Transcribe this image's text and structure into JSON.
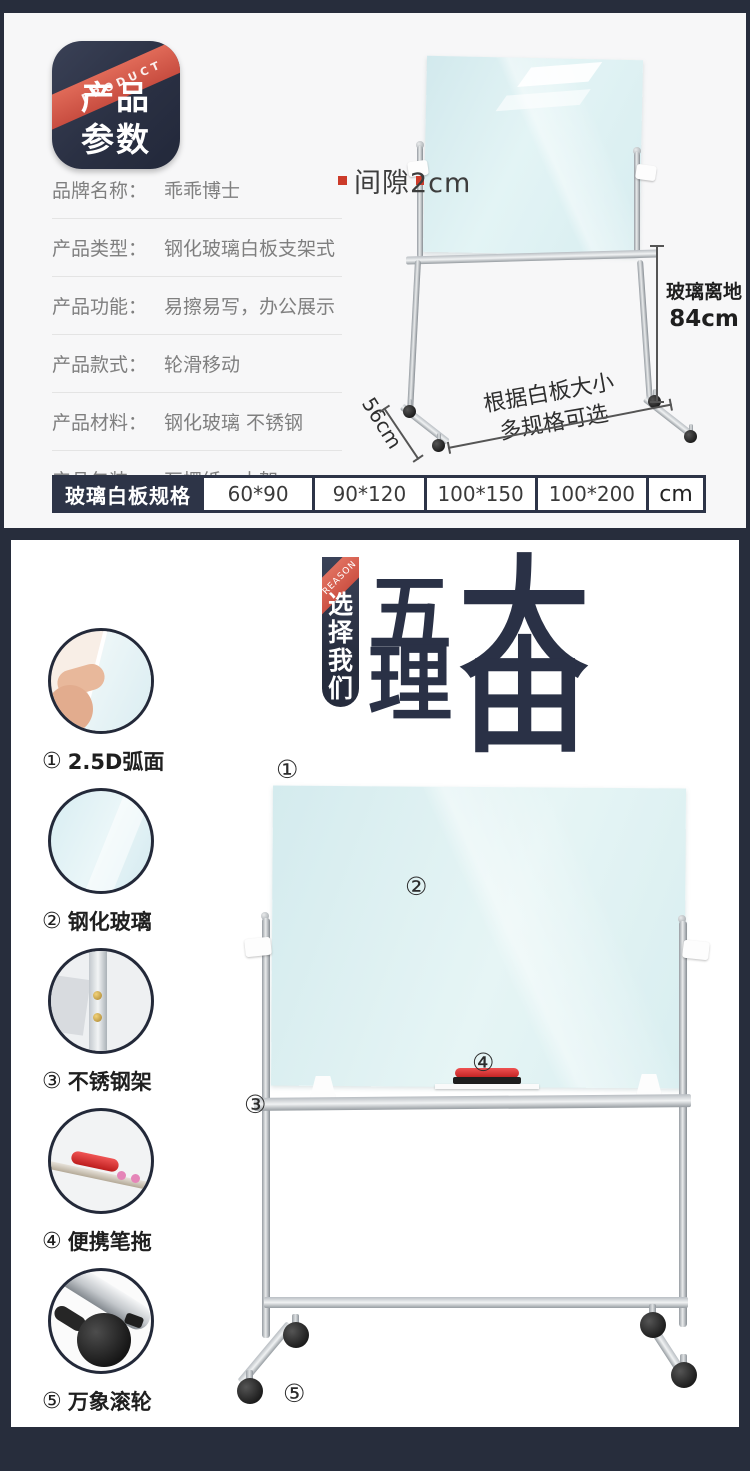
{
  "colors": {
    "navy_background": "#272d3c",
    "table_navy": "#2d3447",
    "ribbon_red": "#d5574b",
    "glass_blue": "#d9eef1",
    "card_gray": "#f7f7f8"
  },
  "params_section": {
    "badge": {
      "ribbon_label": "PRODUCT",
      "title_line1": "产品",
      "title_line2": "参数"
    },
    "rows": [
      {
        "label": "品牌名称：",
        "value": "乖乖博士"
      },
      {
        "label": "产品类型：",
        "value": "钢化玻璃白板支架式"
      },
      {
        "label": "产品功能：",
        "value": "易擦易写，办公展示"
      },
      {
        "label": "产品款式：",
        "value": "轮滑移动"
      },
      {
        "label": "产品材料：",
        "value": "钢化玻璃 不锈钢"
      },
      {
        "label": "产品包装：",
        "value": "瓦楞纸、木架"
      }
    ],
    "annotations": {
      "gap_label": "间隙2cm",
      "ground_clearance_line1": "玻璃离地",
      "ground_clearance_line2": "84cm",
      "depth_label": "56cm",
      "size_note_line1": "根据白板大小",
      "size_note_line2": "多规格可选"
    },
    "spec_table": {
      "header": "玻璃白板规格",
      "sizes": [
        "60*90",
        "90*120",
        "100*150",
        "100*200"
      ],
      "unit": "cm"
    }
  },
  "reasons_section": {
    "ribbon": {
      "diagonal_label": "REASON",
      "chars": [
        "选",
        "择",
        "我",
        "们"
      ]
    },
    "title": {
      "chars": [
        "五",
        "大",
        "理",
        "由"
      ]
    },
    "features": [
      {
        "num": "①",
        "label": "2.5D弧面"
      },
      {
        "num": "②",
        "label": "钢化玻璃"
      },
      {
        "num": "③",
        "label": "不锈钢架"
      },
      {
        "num": "④",
        "label": "便携笔拖"
      },
      {
        "num": "⑤",
        "label": "万象滚轮"
      }
    ],
    "markers": [
      "①",
      "②",
      "③",
      "④",
      "⑤"
    ]
  }
}
